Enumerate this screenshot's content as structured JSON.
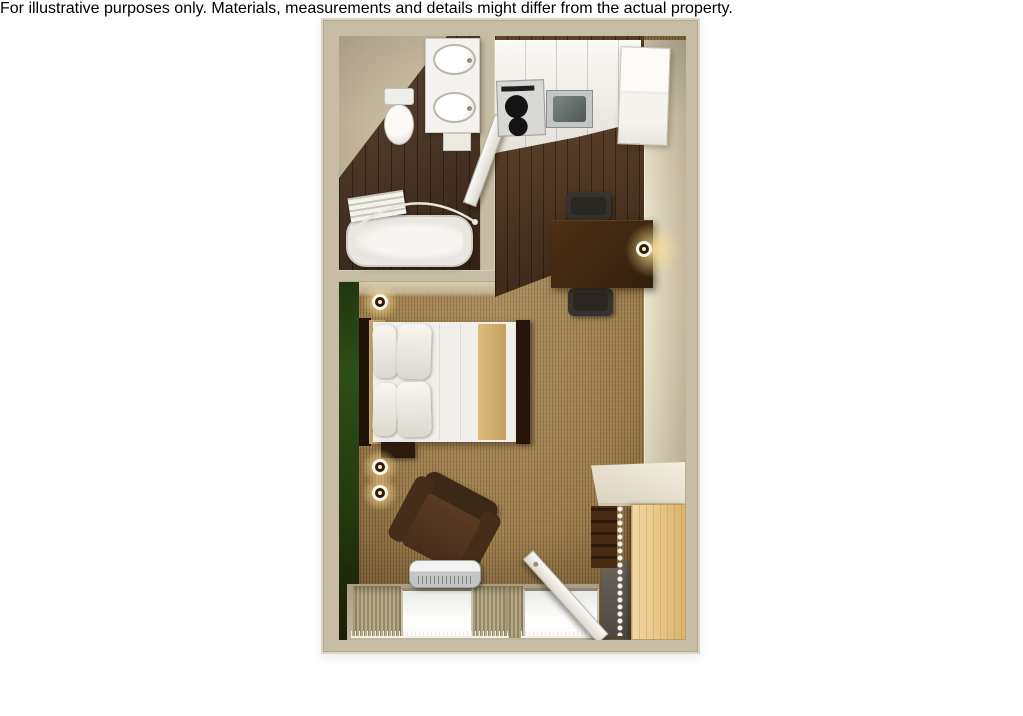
{
  "caption": "For illustrative purposes only.  Materials, measurements and details might differ from the actual property.",
  "entrance_marker": {
    "icon": "entrance-arrow-icon",
    "direction": "up",
    "color": "#0f0f0f"
  },
  "floor_plan": {
    "view": "3d-top-down-studio-suite",
    "palette": {
      "wall": "#c6bda4",
      "wall_edge": "#dcd5c0",
      "accent_wall_green": "#2f5219",
      "carpet": "#9d7e4e",
      "bathroom_wood": "#46301f",
      "kitchen_wood": "#573a23",
      "counter_white": "#f1f0ec",
      "wardrobe_maple": "#e5c385",
      "furniture_brown": "#3b2414"
    },
    "rooms": [
      {
        "name": "bathroom",
        "position": "top-left",
        "items": [
          "double-sink-vanity",
          "toilet",
          "bathtub",
          "shower-curtain-rod",
          "towel-bar",
          "open-door"
        ]
      },
      {
        "name": "kitchen",
        "position": "top-right",
        "items": [
          "stovetop",
          "kitchen-sink",
          "counter",
          "refrigerator-cabinet"
        ]
      },
      {
        "name": "main-room",
        "position": "center",
        "items": [
          "queen-bed",
          "pillows",
          "bed-runner",
          "headboard",
          "nightstand",
          "wall-sconce-bed",
          "wall-sconce-upper",
          "wall-sconce-lower",
          "dining-table",
          "dining-chair-north",
          "dining-chair-south",
          "table-lamp",
          "tv-dresser",
          "television",
          "armchair",
          "ptac-heater",
          "window-left",
          "window-right",
          "curtains",
          "entry-door",
          "entry-mat",
          "closet-shelf",
          "clothes-rod",
          "wardrobe-cabinet",
          "shelving-unit"
        ]
      }
    ]
  }
}
